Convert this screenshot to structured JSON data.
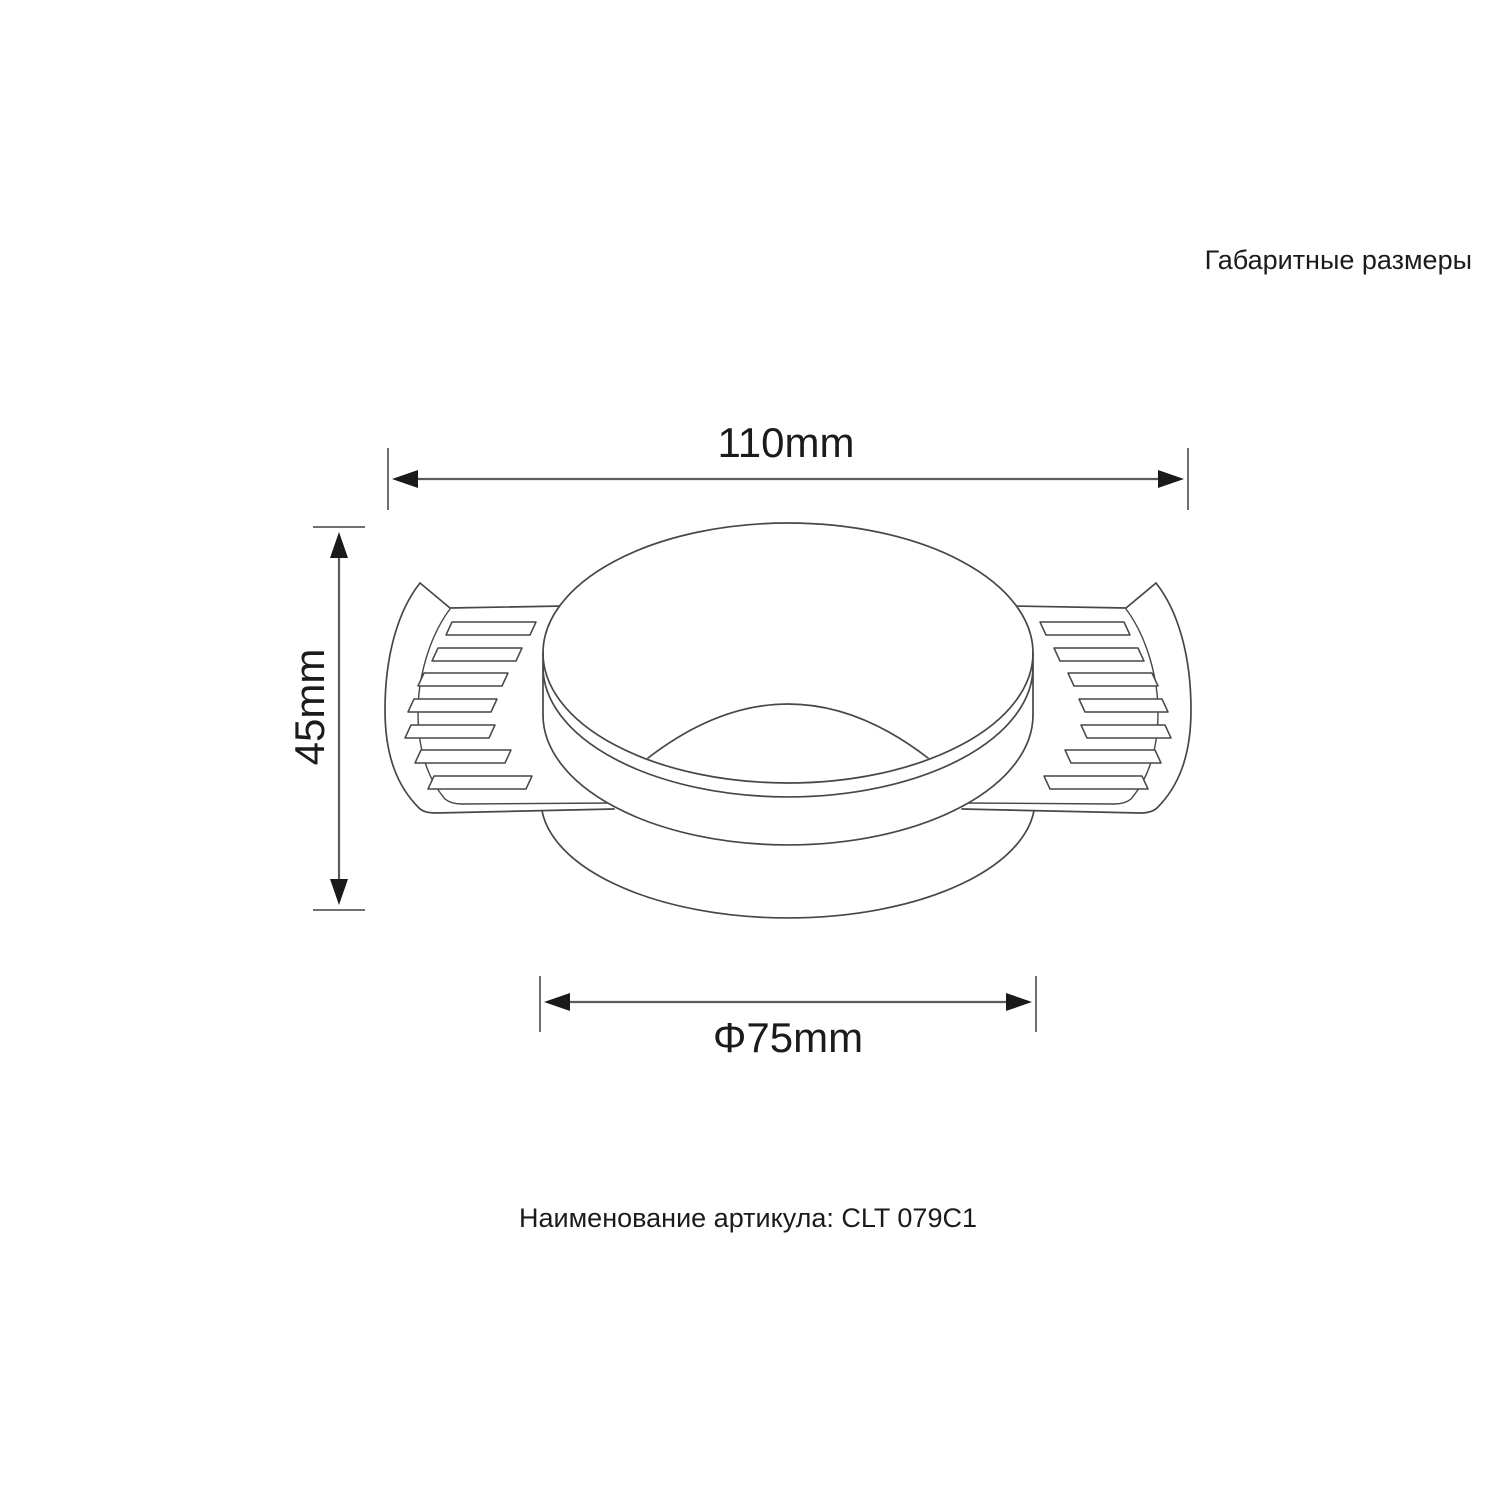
{
  "page": {
    "background": "#ffffff",
    "title": "Габаритные размеры"
  },
  "dimensions": {
    "overall_width": "110mm",
    "overall_height": "45mm",
    "cutout_diameter": "Φ75mm"
  },
  "footer": {
    "label": "Наименование артикула:",
    "code": "CLT 079C1"
  },
  "colors": {
    "outline": "#474747",
    "dimension_line": "#5c5c5c",
    "extension_tick": "#707070",
    "arrow": "#1a1a1a",
    "text": "#1b1b1b"
  }
}
